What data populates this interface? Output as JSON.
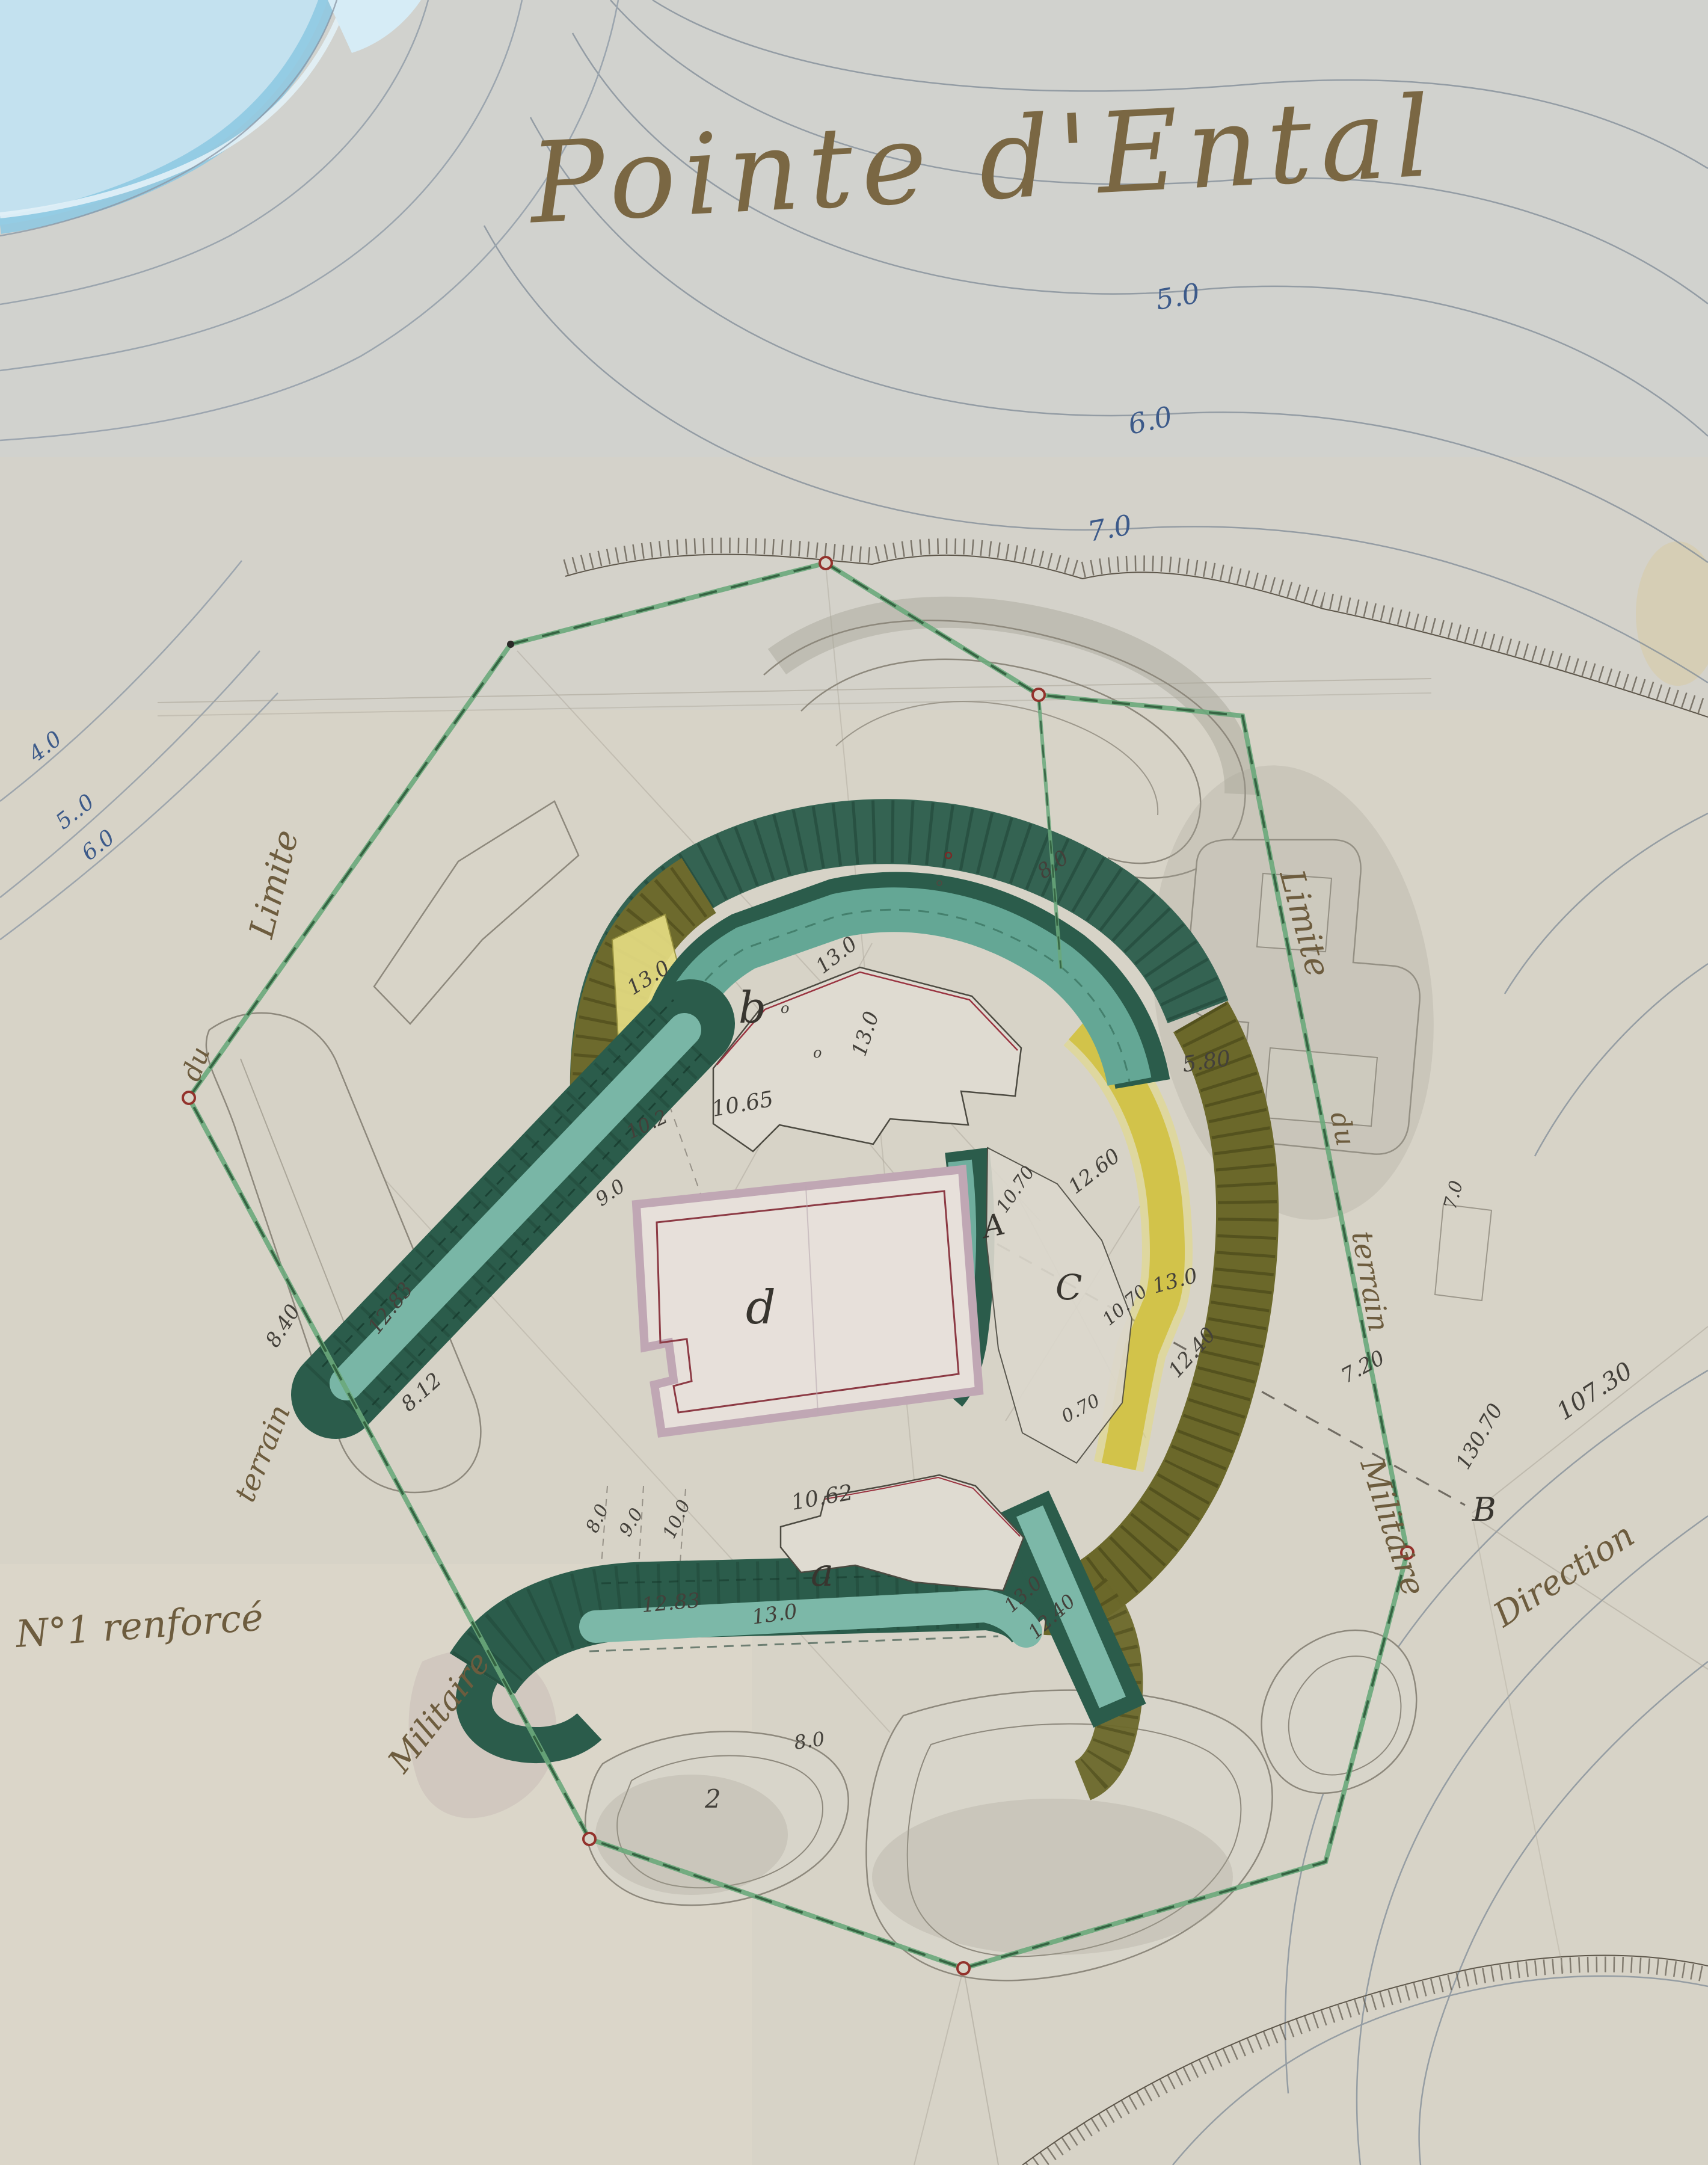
{
  "notes": {
    "title": "Pointe d'Ental",
    "limite": "Limite",
    "du": "du",
    "terrain": "terrain",
    "militaire": "Militaire",
    "no1": "N°1 renforcé",
    "direction": "Direction"
  },
  "contours": {
    "c5": "5.0",
    "c6": "6.0",
    "c7": "7.0",
    "l4": "4.0",
    "l5": "5..0",
    "l6": "6.0"
  },
  "elev": {
    "v13": "13.0",
    "v10_65": "10.65",
    "v10_2": "10.2",
    "v9_0": "9.0",
    "v8_40": "8.40",
    "v12_83": "12.83",
    "v8_12": "8.12",
    "v8_0": "8.0",
    "v5_80": "5.80",
    "v12_60": "12.60",
    "v12_40": "12.40",
    "v10_70": "10.70",
    "v0_70": "0.70",
    "v7_20": "7.20",
    "v130_70": "130.70",
    "v107_30": "107.30",
    "v10_62": "10.62",
    "v10_0": "10.0",
    "v7_0": "7.0",
    "v2": "2",
    "vo": "o"
  },
  "letters": {
    "a": "a",
    "b": "b",
    "c": "C",
    "d": "d",
    "A": "A",
    "B": "B"
  },
  "colors": {
    "paper": "#d7d3c7",
    "sea": "#c3e1ef",
    "boundary_green": "#6aa87b",
    "rampart_dark": "#2b5c4b",
    "rampart_teal": "#6fb0a0",
    "rampart_olive": "#6b682a",
    "rampart_yellow": "#d2c34a",
    "building_mauve": "#c0a7b4",
    "vertex_red": "#93322c",
    "contour_blue_label": "#3c5a8a"
  }
}
